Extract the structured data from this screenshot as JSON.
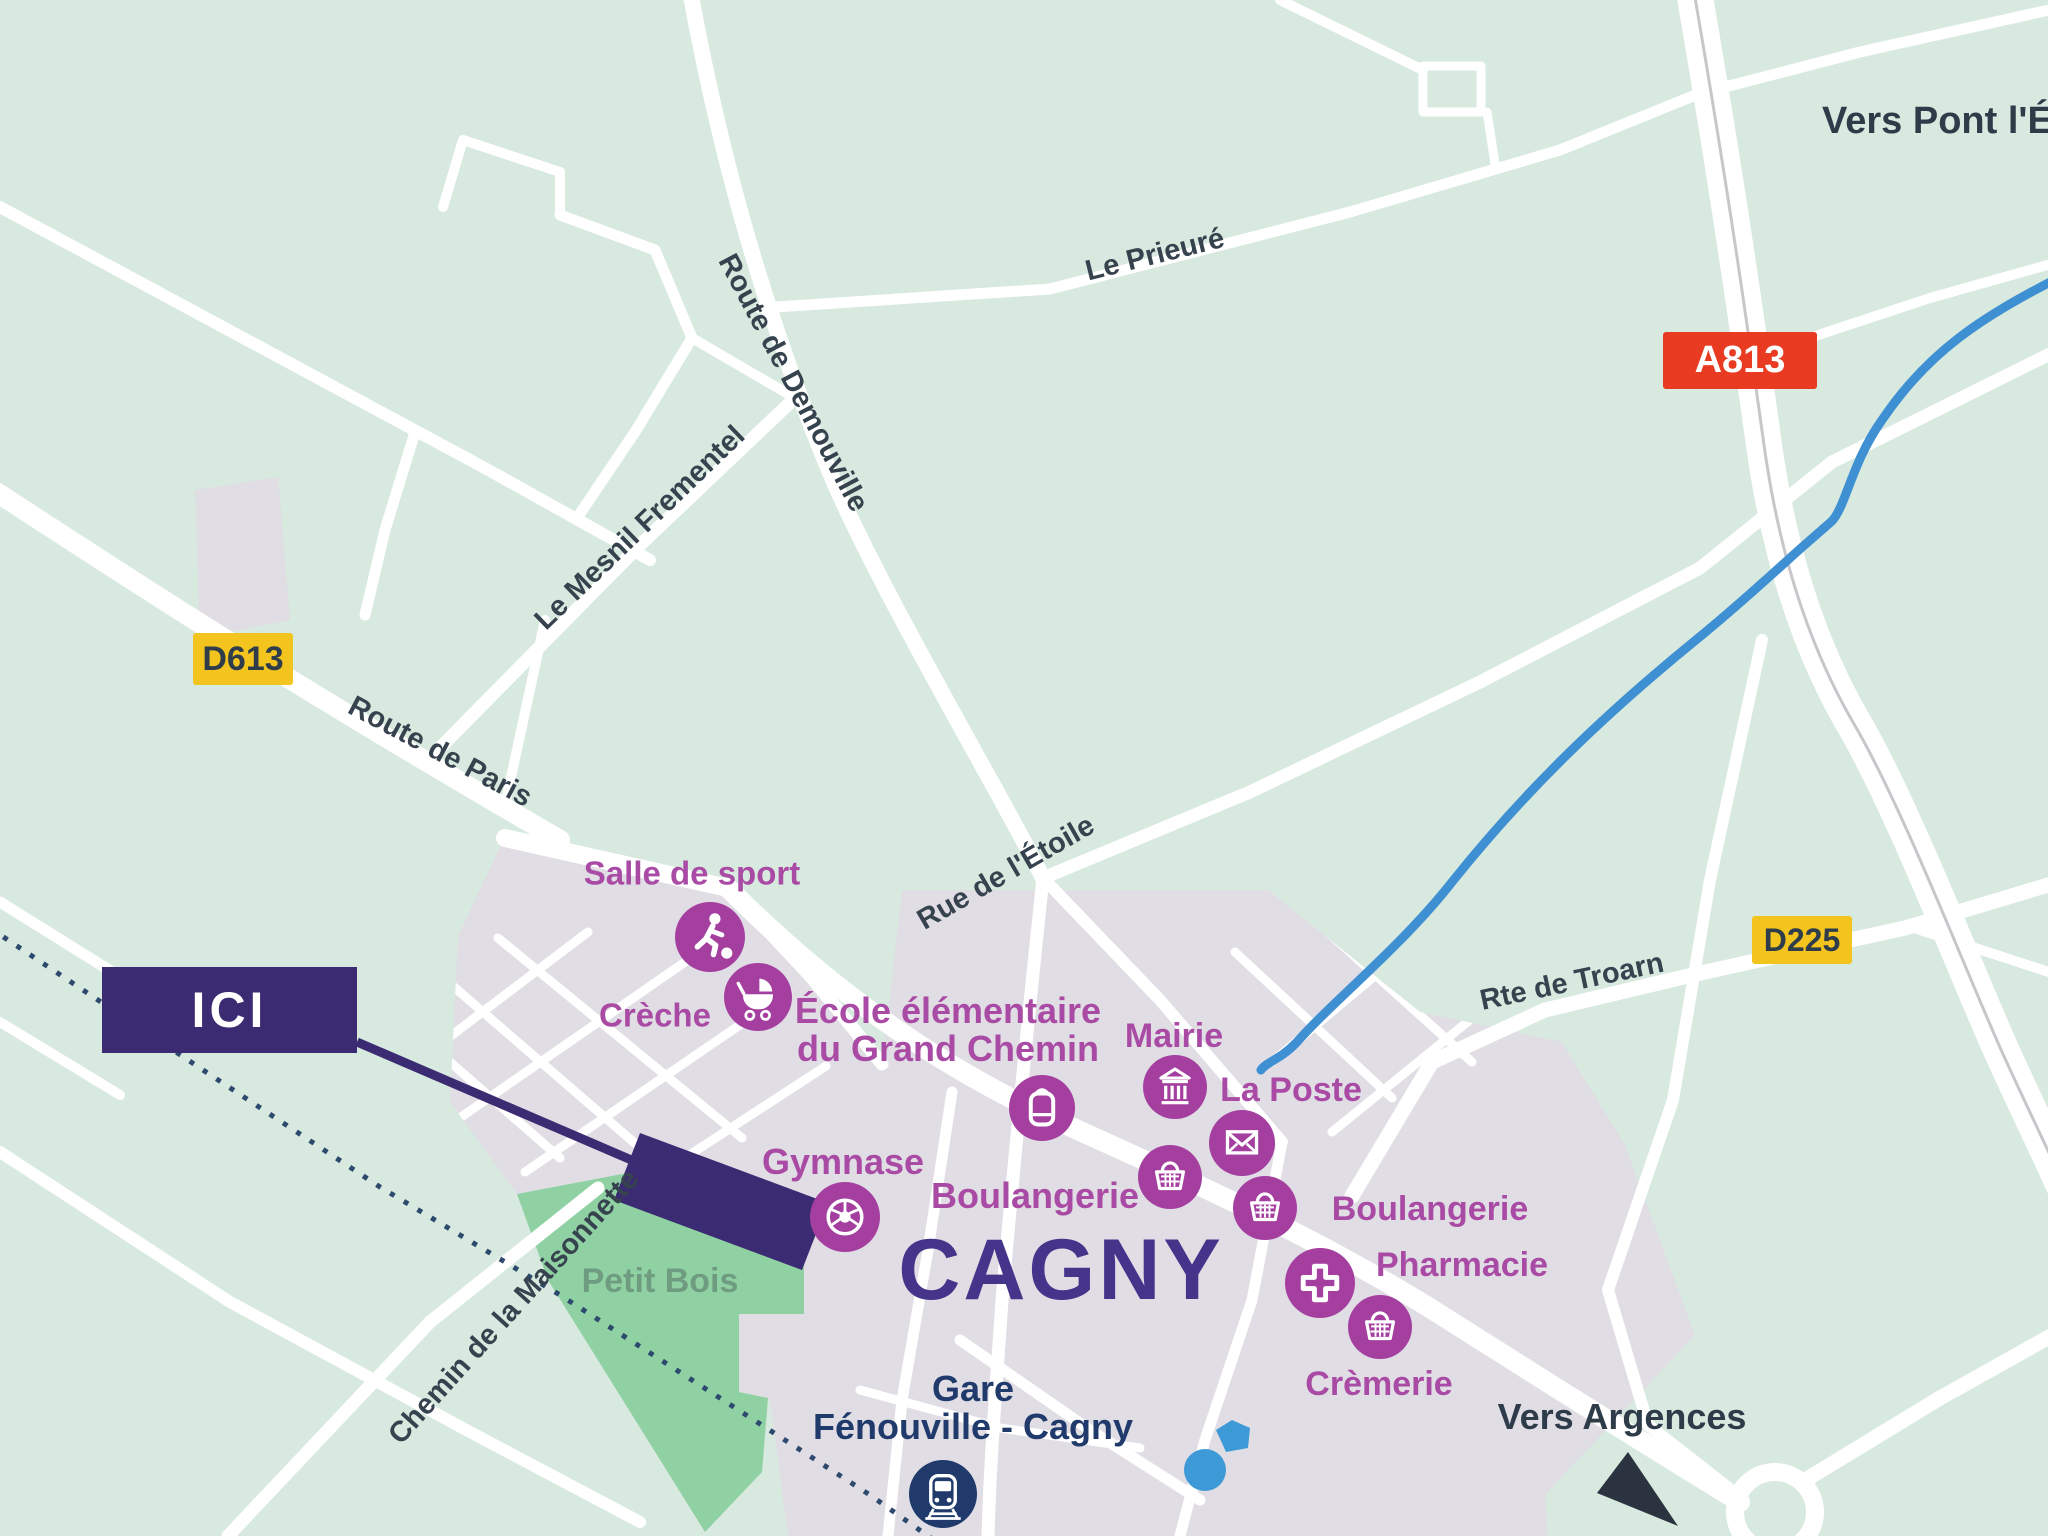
{
  "map": {
    "town_title": "CAGNY",
    "here_marker": "ICI",
    "badges": {
      "d613": "D613",
      "a813": "A813",
      "d225": "D225"
    },
    "roads": {
      "route_de_paris": "Route de Paris",
      "route_de_demouville": "Route de Demouville",
      "le_mesnil_frementel": "Le Mesnil Frementel",
      "le_prieure": "Le Prieuré",
      "rue_de_letoile": "Rue de l'Étoile",
      "rte_de_troarn": "Rte de Troarn",
      "chemin_de_la_maisonnette": "Chemin de la Maisonnette"
    },
    "directions": {
      "pont_leveque": "Vers Pont l'Évê",
      "argences": "Vers Argences"
    },
    "areas": {
      "petit_bois": "Petit Bois"
    },
    "station": {
      "line1": "Gare",
      "line2": "Fénouville - Cagny"
    },
    "pois": [
      {
        "label": "Salle de sport",
        "icon": "runner-icon"
      },
      {
        "label": "Crèche",
        "icon": "stroller-icon"
      },
      {
        "label": "École élémentaire",
        "label2": "du Grand Chemin",
        "icon": "backpack-icon"
      },
      {
        "label": "Mairie",
        "icon": "town-hall-icon"
      },
      {
        "label": "La Poste",
        "icon": "envelope-icon"
      },
      {
        "label": "Boulangerie",
        "icon": "basket-icon"
      },
      {
        "label": "Boulangerie",
        "icon": "basket-icon"
      },
      {
        "label": "Pharmacie",
        "icon": "medical-cross-icon"
      },
      {
        "label": "Crèmerie",
        "icon": "basket-icon"
      },
      {
        "label": "Gymnase",
        "icon": "soccer-ball-icon"
      }
    ],
    "colors": {
      "background_green": "#d8e9df",
      "town_gray": "#e0dde4",
      "road_white": "#ffffff",
      "wood_green": "#90d1a3",
      "wood_label": "#6f9c81",
      "water_blue": "#3f90d2",
      "pond_blue": "#3d9ad7",
      "poi_magenta": "#a43fa0",
      "poi_label_magenta": "#a94aa5",
      "here_purple": "#3b2b72",
      "town_title_purple": "#44348a",
      "station_navy": "#1f3a6b",
      "railway_navy": "#2d4a6e",
      "road_label_slate": "#36434f",
      "d_badge_yellow": "#f2c41d",
      "a_badge_red": "#e83b21",
      "direction_dark": "#2e3b49"
    }
  }
}
